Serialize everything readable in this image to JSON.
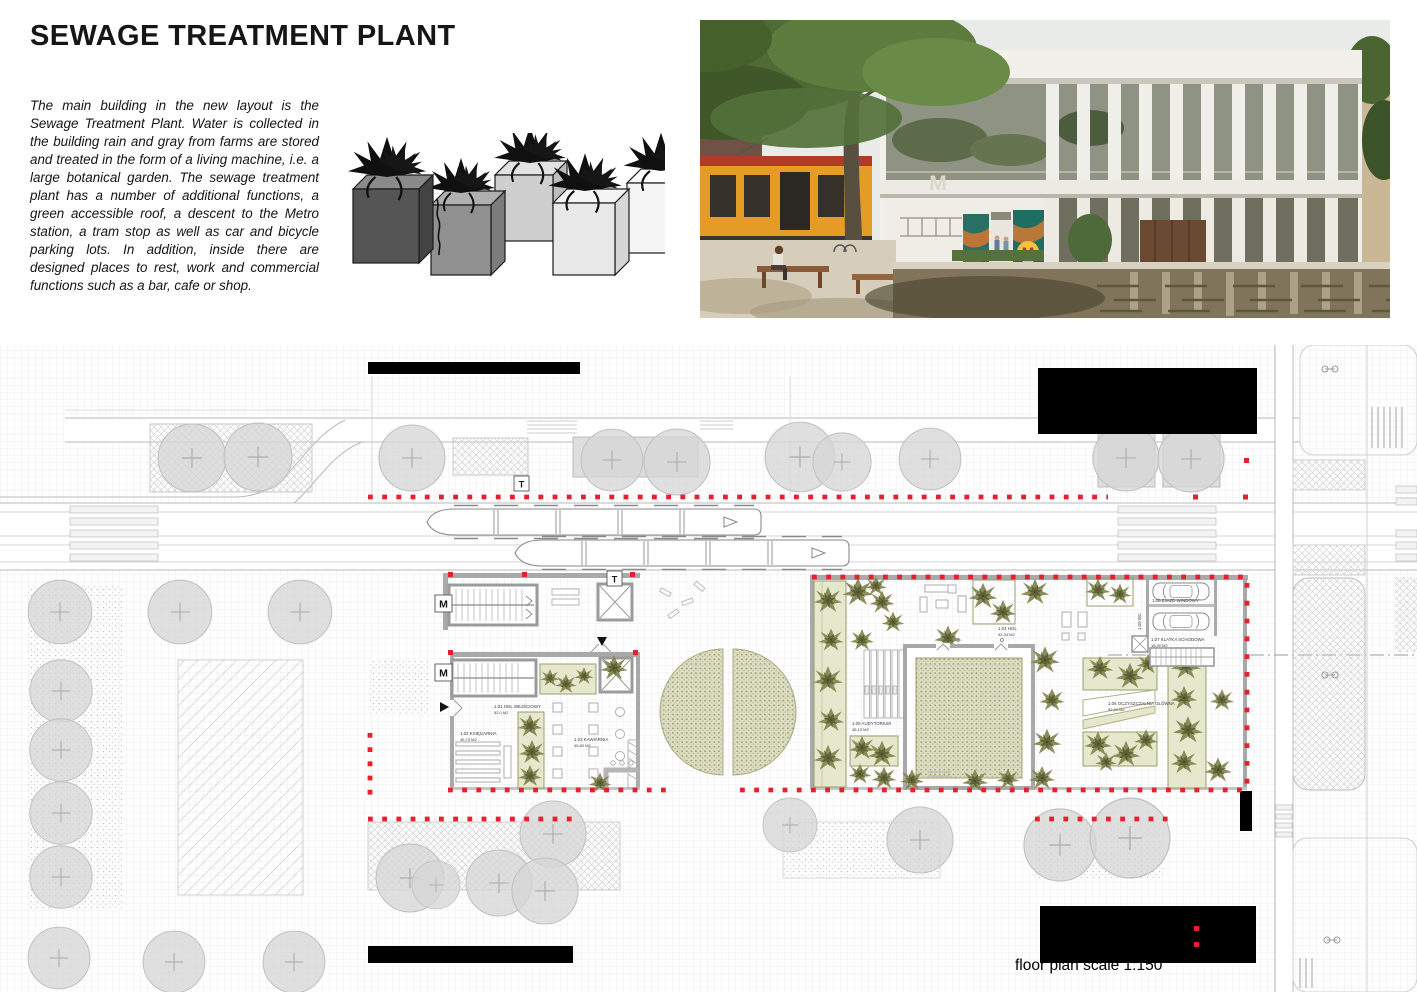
{
  "header": {
    "title": "SEWAGE TREATMENT PLANT",
    "description": "The main building in the new layout is the Sewage Treatment Plant. Water is collected in the building rain and gray from farms are stored and treated in the form of a living machine, i.e. a large botanical garden. The sewage treatment plant has a number of additional functions, a green accessible roof, a descent to the Metro station, a tram stop as well as car and bicycle parking lots. In addition, inside there are designed places to rest, work and commercial functions such as a bar, cafe or shop."
  },
  "render": {
    "metro_logo": "M"
  },
  "plan": {
    "scale_note": "floor plan scale 1:150",
    "markers": {
      "metro": "M",
      "tram": "T"
    },
    "rooms": [
      {
        "name": "1.01 HOL WEJŚCIOWY",
        "area": "52,0 M2"
      },
      {
        "name": "1.02 KSIĘGARNIA",
        "area": "45,70 M2"
      },
      {
        "name": "1.03 KAWIARNIA",
        "area": "45,60 M2"
      },
      {
        "name": "1.04 HOL",
        "area": "92,34 M2"
      },
      {
        "name": "1.05 AUDYTORIUM",
        "area": "46,10 M2"
      },
      {
        "name": "1.06 OCZYSZCZALNIA GŁÓWNA",
        "area": "92,34 M2"
      },
      {
        "name": "1.07 KLATKA SCHODOWA",
        "area": "16,40 M2"
      },
      {
        "name": "1.08 ZJAZD WINDOWY",
        "area": ""
      },
      {
        "name": "1.09 WC",
        "area": ""
      }
    ],
    "colors": {
      "boundary_red": "#e8202e",
      "vegetation_olive": "#80834c",
      "tree_gray": "#d6d6d6",
      "existing_building_black": "#000000"
    }
  }
}
